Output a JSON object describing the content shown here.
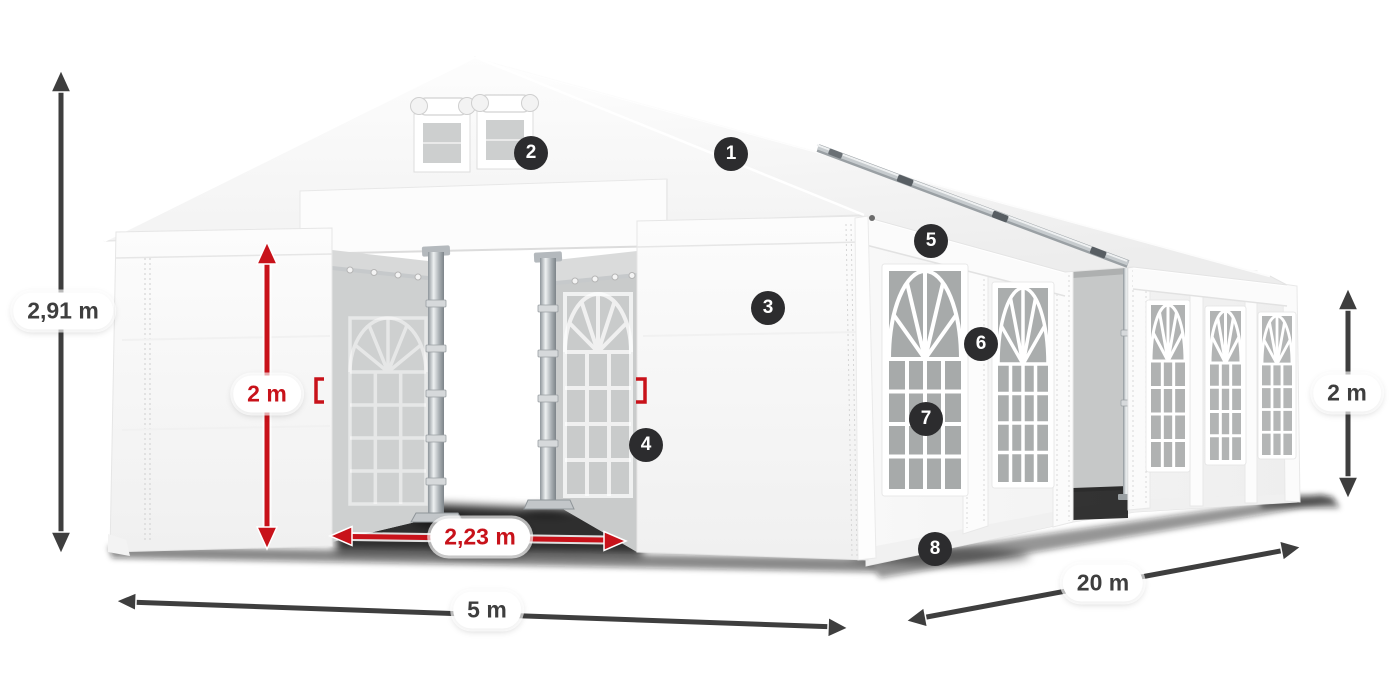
{
  "diagram": {
    "kind": "tent-dimension-diagram"
  },
  "colors": {
    "accent-red": "#c8121a",
    "dim-dark": "#3e3e3e",
    "badge-bg": "#2c2c2e",
    "badge-text": "#ffffff",
    "pill-bg": "#ffffff"
  },
  "dimensions": [
    {
      "id": "total-height",
      "label": "2,91 m",
      "style": "dark",
      "orientation": "vertical"
    },
    {
      "id": "front-wall-height",
      "label": "2 m",
      "style": "red",
      "orientation": "vertical"
    },
    {
      "id": "entrance-width",
      "label": "2,23 m",
      "style": "red",
      "orientation": "horizontal"
    },
    {
      "id": "tent-width",
      "label": "5 m",
      "style": "dark",
      "orientation": "horizontal"
    },
    {
      "id": "tent-length",
      "label": "20 m",
      "style": "dark",
      "orientation": "diagonal"
    },
    {
      "id": "side-wall-height",
      "label": "2 m",
      "style": "dark",
      "orientation": "vertical"
    }
  ],
  "badges": [
    {
      "n": "1"
    },
    {
      "n": "2"
    },
    {
      "n": "3"
    },
    {
      "n": "4"
    },
    {
      "n": "5"
    },
    {
      "n": "6"
    },
    {
      "n": "7"
    },
    {
      "n": "8"
    }
  ]
}
